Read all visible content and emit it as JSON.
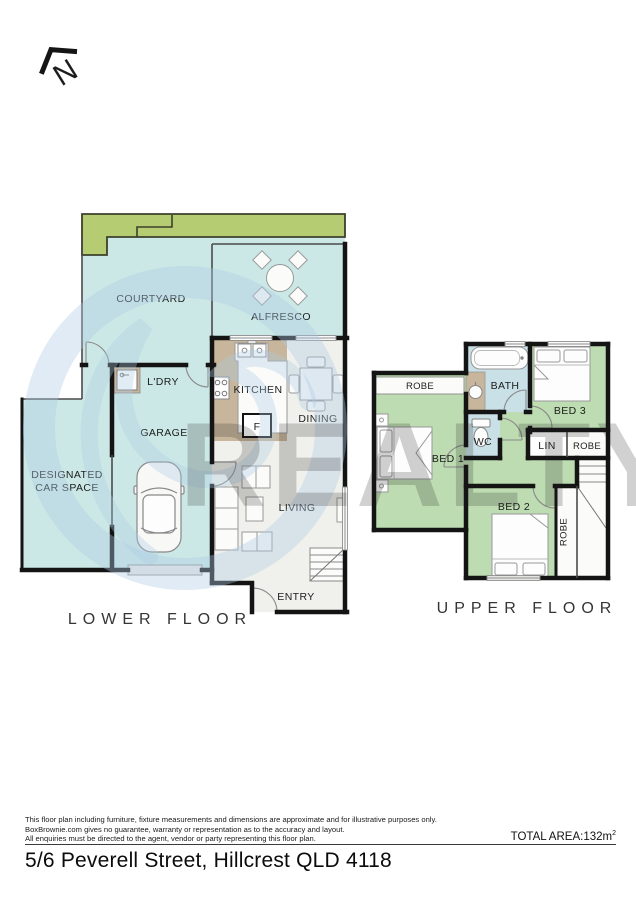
{
  "north": {
    "label": "N"
  },
  "lower": {
    "title": "LOWER FLOOR",
    "courtyard": "COURTYARD",
    "alfresco": "ALFRESCO",
    "laundry": "L'DRY",
    "kitchen": "KITCHEN",
    "dining": "DINING",
    "fridge": "F",
    "garage": "GARAGE",
    "car_space_line1": "DESIGNATED",
    "car_space_line2": "CAR SPACE",
    "living": "LIVING",
    "entry": "ENTRY"
  },
  "upper": {
    "title": "UPPER FLOOR",
    "robe_bed1": "ROBE",
    "bath": "BATH",
    "bed3": "BED 3",
    "wc": "WC",
    "linen": "LIN",
    "robe_bed3": "ROBE",
    "bed1": "BED 1",
    "bed2": "BED 2",
    "robe_bed2": "ROBE"
  },
  "watermark": {
    "text": "REALTY"
  },
  "footer": {
    "disclaimer_line1": "This floor plan including furniture, fixture measurements and dimensions are approximate and for illustrative purposes only.",
    "disclaimer_line2": "BoxBrownie.com gives no guarantee, warranty or representation as to the accuracy and layout.",
    "disclaimer_line3": "All enquiries must be directed to the agent, vendor or party representing this floor plan.",
    "total_area_label": "TOTAL AREA:132m",
    "total_area_sup": "2",
    "address": "5/6 Peverell Street, Hillcrest QLD 4118"
  },
  "colors": {
    "outdoor": "#cbe8e6",
    "garden": "#b6cc72",
    "bedroom": "#bddcb2",
    "bath": "#c8e0e6",
    "tile": "#c7b69b",
    "interior_floor": "#f0f1ec",
    "wall": "#141414",
    "watermark": "#aecbe4"
  }
}
